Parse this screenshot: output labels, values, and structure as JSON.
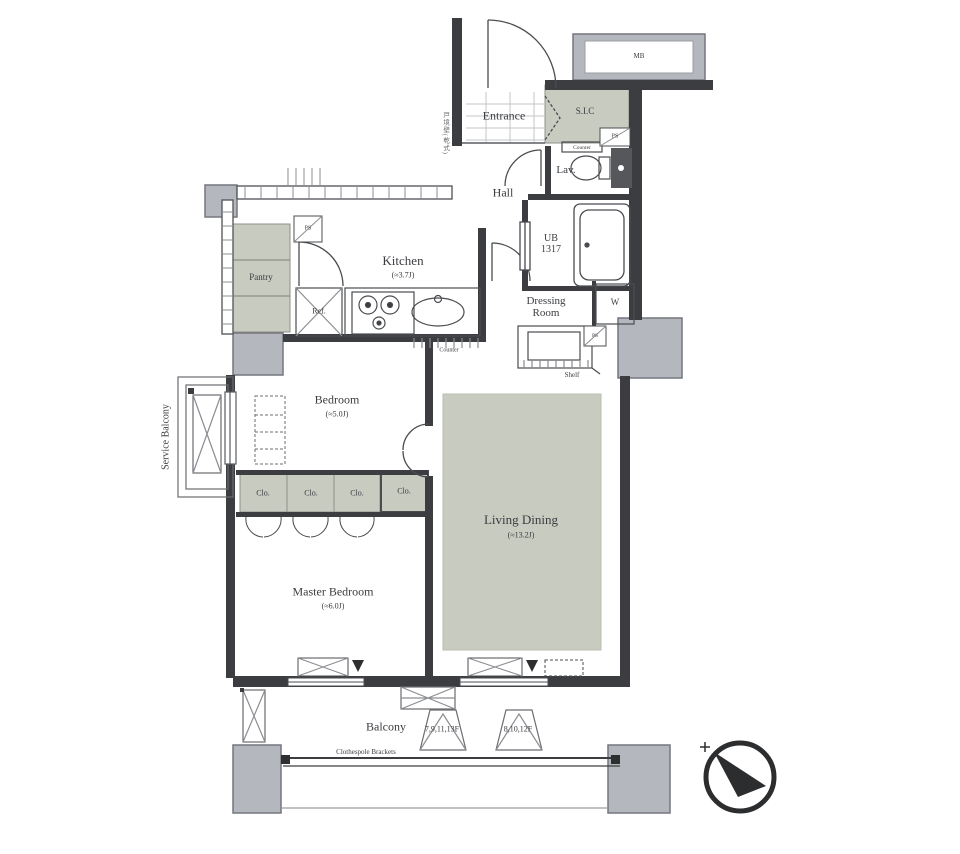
{
  "colors": {
    "shaded": "#c8cbc0",
    "column": "#b4b7bd",
    "wall": "#3b3d40"
  },
  "rooms": {
    "entrance": {
      "label": "Entrance"
    },
    "sic": {
      "label": "S.I.C"
    },
    "hall": {
      "label": "Hall"
    },
    "lav": {
      "label": "Lav."
    },
    "ub": {
      "l1": "UB",
      "l2": "1317"
    },
    "dressing": {
      "l1": "Dressing",
      "l2": "Room"
    },
    "washer": {
      "label": "W"
    },
    "kitchen": {
      "label": "Kitchen",
      "area": "(≈3.7J)"
    },
    "pantry": {
      "label": "Pantry"
    },
    "ref": {
      "label": "Ref."
    },
    "bedroom": {
      "label": "Bedroom",
      "area": "(≈5.0J)"
    },
    "master_bedroom": {
      "label": "Master Bedroom",
      "area": "(≈6.0J)"
    },
    "living_dining": {
      "label": "Living Dining",
      "area": "(≈13.2J)"
    },
    "service_balcony": {
      "label": "Service Balcony"
    },
    "balcony": {
      "label": "Balcony"
    },
    "closets": [
      {
        "label": "Clo."
      },
      {
        "label": "Clo."
      },
      {
        "label": "Clo."
      },
      {
        "label": "Clo."
      }
    ]
  },
  "annotations": {
    "mb": "MB",
    "ps": "PS",
    "shelf": "Shelf",
    "counter": "Counter",
    "lav_counter": "Counter",
    "clothespole": "Clothespole Brackets",
    "floors_a": "7,9,11,13F",
    "floors_b": "8,10,12F",
    "wall_note": "戸境壁(乾式)"
  }
}
